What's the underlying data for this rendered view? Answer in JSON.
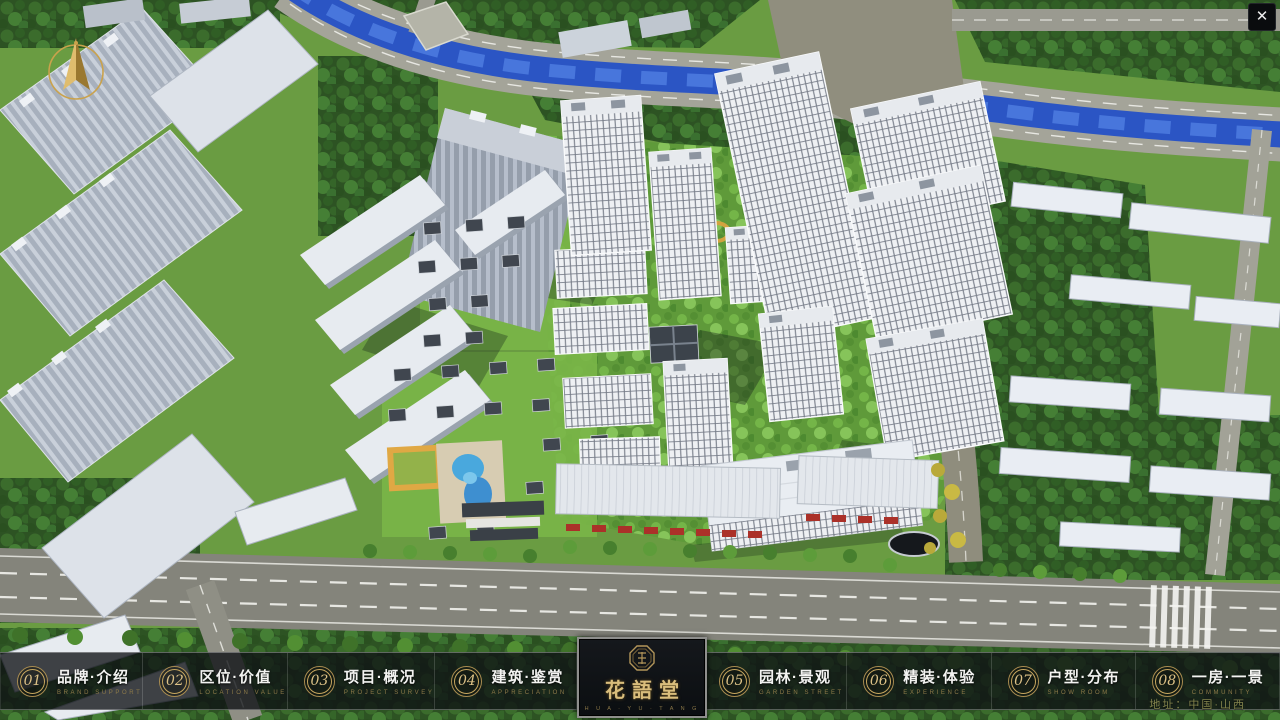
{
  "window": {
    "close_label": "✕"
  },
  "scene": {
    "description": "aerial masterplan render of residential development",
    "compass": "north-compass",
    "landmarks": [
      "river",
      "main-road",
      "residential-towers",
      "courtyard-houses",
      "swimming-pool",
      "commercial-street"
    ]
  },
  "navbar": {
    "items": [
      {
        "num": "01",
        "label": "品牌·介绍",
        "sub": "BRAND SUPPORT"
      },
      {
        "num": "02",
        "label": "区位·价值",
        "sub": "LOCATION VALUE"
      },
      {
        "num": "03",
        "label": "项目·概况",
        "sub": "PROJECT SURVEY"
      },
      {
        "num": "04",
        "label": "建筑·鉴赏",
        "sub": "APPRECIATION"
      },
      {
        "num": "05",
        "label": "园林·景观",
        "sub": "GARDEN STREET"
      },
      {
        "num": "06",
        "label": "精装·体验",
        "sub": "EXPERIENCE"
      },
      {
        "num": "07",
        "label": "户型·分布",
        "sub": "SHOW ROOM"
      },
      {
        "num": "08",
        "label": "一房·一景",
        "sub": "COMMUNITY"
      }
    ]
  },
  "logo": {
    "title": "花語堂",
    "subtext": "H U A · Y U · T A N G"
  },
  "footer": {
    "address": "地址：中国·山西"
  },
  "colors": {
    "accent_gold": "#c9a961",
    "bar_background": "#0e1114",
    "river_blue": "#2b55c4",
    "grass_green": "#6a9c42",
    "label_white": "#f3f3f1",
    "sub_gold": "#8d7a49"
  }
}
